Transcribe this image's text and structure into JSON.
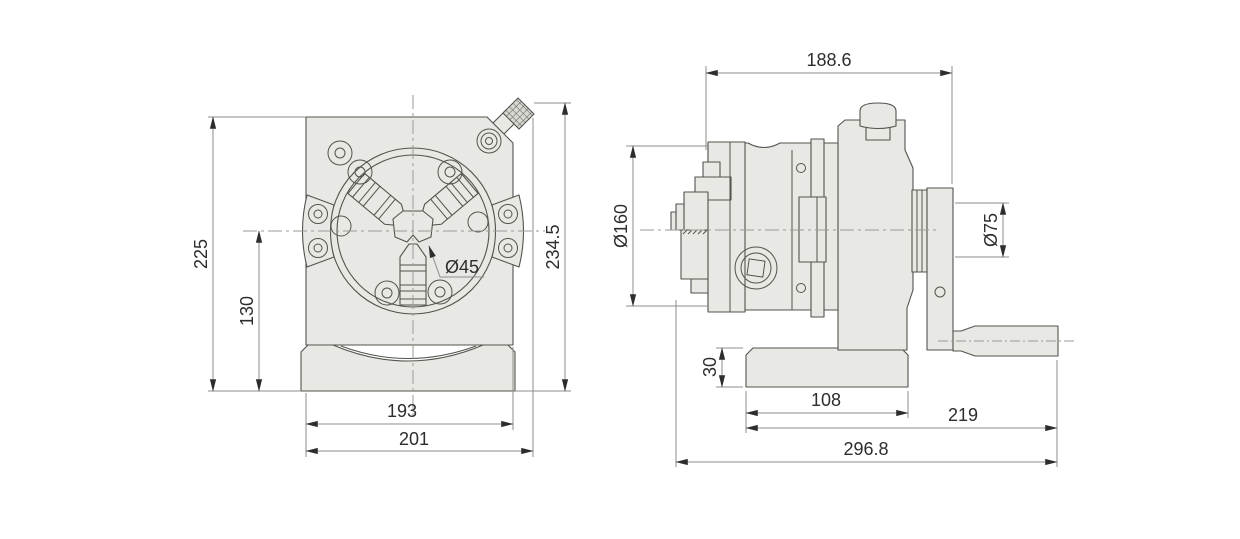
{
  "document": {
    "type": "engineering line drawing, two orthographic views of a dividing head with 3-jaw chuck",
    "views": [
      "front view",
      "side view"
    ]
  },
  "colors": {
    "background": "#ffffff",
    "part_fill": "#e8e8e4",
    "knurl_fill": "#dcdcd8",
    "outline": "#54534e",
    "dim_line": "#8f8e8a",
    "dim_text": "#2e2d2b",
    "centerline": "#9b9a96"
  },
  "front_view": {
    "name": "front view",
    "dims": {
      "height_overall": "225",
      "height_center": "130",
      "height_total": "234.5",
      "bore": "Ø45",
      "width_body": "193",
      "width_base": "201"
    }
  },
  "side_view": {
    "name": "side view",
    "dims": {
      "length_top": "188.6",
      "chuck_dia": "Ø160",
      "flange_dia": "Ø75",
      "base_height": "30",
      "base_length": "108",
      "length_mid": "219",
      "length_overall": "296.8"
    }
  }
}
